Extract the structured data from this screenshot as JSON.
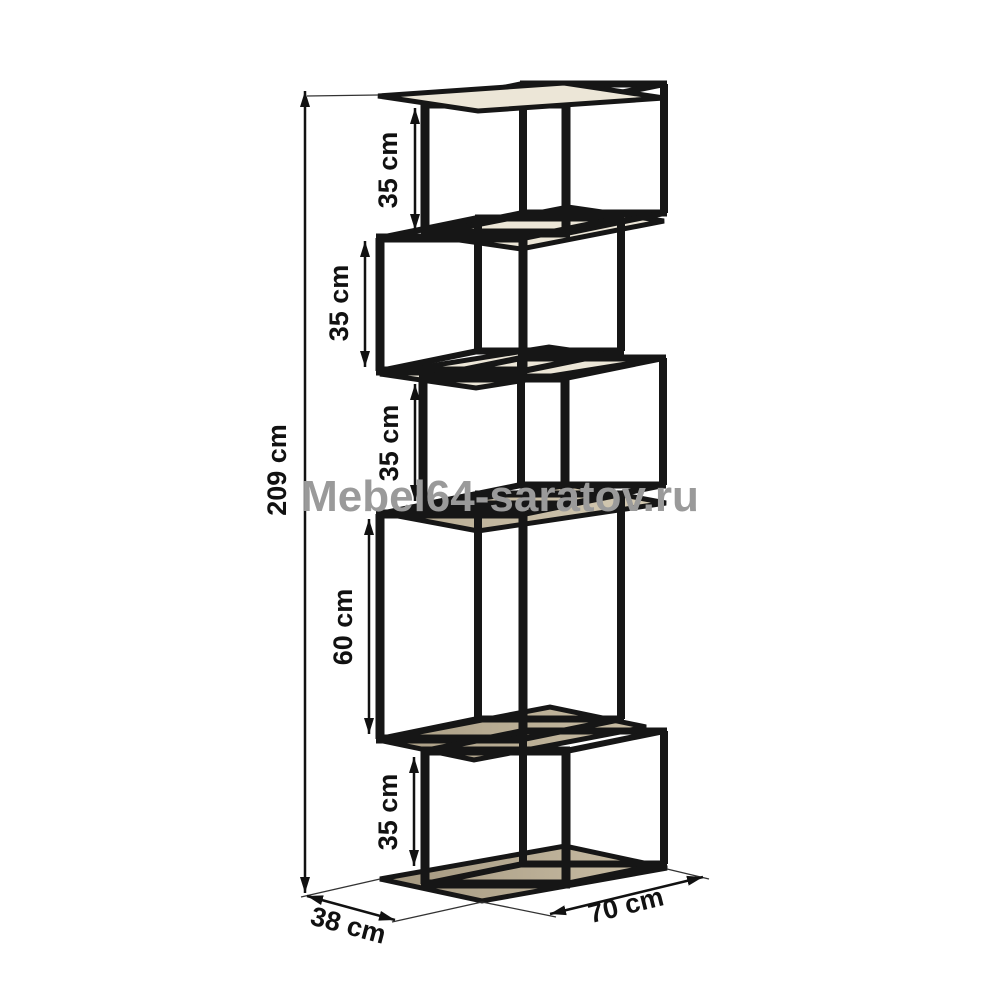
{
  "watermark": {
    "text": "Mebel64-saratov.ru",
    "color": "#9a9a9a"
  },
  "colors": {
    "frame": "#161616",
    "dimension_line": "#111111",
    "wood_dark": "#a2967e",
    "wood_mid": "#b6aa91",
    "wood_light": "#cdc1a8",
    "cream": "#ece6d7",
    "background": "#ffffff",
    "watermark_gray": "#9a9a9a"
  },
  "figure": {
    "description": "zigzag-shelving-unit-dimension-drawing",
    "total_height_label": "209 cm",
    "section_labels": [
      "35 cm",
      "35 cm",
      "35 cm",
      "60 cm",
      "35 cm"
    ],
    "depth_label": "38 cm",
    "width_label": "70 cm",
    "boxes": [
      {
        "fx1": 425,
        "fx2": 566,
        "fy1": 104,
        "fy2": 233,
        "dx": 98,
        "dy": -20
      },
      {
        "fx1": 380,
        "fx2": 523,
        "fy1": 238,
        "fy2": 371,
        "dx": 98,
        "dy": -20
      },
      {
        "fx1": 423,
        "fx2": 565,
        "fy1": 378,
        "fy2": 505,
        "dx": 98,
        "dy": -20
      },
      {
        "fx1": 380,
        "fx2": 523,
        "fy1": 514,
        "fy2": 739,
        "dx": 98,
        "dy": -20
      },
      {
        "fx1": 425,
        "fx2": 566,
        "fy1": 751,
        "fy2": 884,
        "dx": 98,
        "dy": -20
      }
    ],
    "shelves": [
      {
        "pts": "425,235 521,249 664,221 568,207",
        "fill": "#ece6d7",
        "layer": "back"
      },
      {
        "pts": "380,374 476,388 645,361 549,347",
        "fill": "#ece6d7",
        "layer": "back"
      },
      {
        "pts": "382,513 478,531 666,503 570,485",
        "fill": "gradMid",
        "layer": "back"
      },
      {
        "pts": "378,740 474,760 646,727 550,707",
        "fill": "gradWood",
        "layer": "back"
      },
      {
        "pts": "380,879 482,901 667,868 565,846",
        "fill": "gradFloor",
        "layer": "back"
      },
      {
        "pts": "378,96 478,111 664,98 564,83",
        "fill": "#ece6d7",
        "layer": "front"
      }
    ],
    "extensions": [
      {
        "x1": 307,
        "y1": 96,
        "x2": 378,
        "y2": 95
      },
      {
        "x1": 380,
        "y1": 879,
        "x2": 301,
        "y2": 897
      },
      {
        "x1": 482,
        "y1": 902,
        "x2": 392,
        "y2": 922
      },
      {
        "x1": 482,
        "y1": 902,
        "x2": 556,
        "y2": 917
      },
      {
        "x1": 667,
        "y1": 869,
        "x2": 709,
        "y2": 879
      }
    ],
    "dims": [
      {
        "name": "dim-total-height",
        "label": "209 cm",
        "x1": 305,
        "y1": 91,
        "x2": 305,
        "y2": 893,
        "lx": 286,
        "ly": 470,
        "rot": -90
      },
      {
        "name": "dim-section-1",
        "label": "35 cm",
        "x1": 415,
        "y1": 108,
        "x2": 415,
        "y2": 230,
        "lx": 397,
        "ly": 170,
        "rot": -90
      },
      {
        "name": "dim-section-2",
        "label": "35 cm",
        "x1": 365,
        "y1": 241,
        "x2": 365,
        "y2": 367,
        "lx": 348,
        "ly": 303,
        "rot": -90
      },
      {
        "name": "dim-section-3",
        "label": "35 cm",
        "x1": 415,
        "y1": 384,
        "x2": 415,
        "y2": 501,
        "lx": 398,
        "ly": 443,
        "rot": -90
      },
      {
        "name": "dim-section-4",
        "label": "60 cm",
        "x1": 369,
        "y1": 519,
        "x2": 369,
        "y2": 734,
        "lx": 352,
        "ly": 627,
        "rot": -90
      },
      {
        "name": "dim-section-5",
        "label": "35 cm",
        "x1": 414,
        "y1": 757,
        "x2": 414,
        "y2": 866,
        "lx": 397,
        "ly": 812,
        "rot": -90
      },
      {
        "name": "dim-depth",
        "label": "38 cm",
        "x1": 307,
        "y1": 896,
        "x2": 395,
        "y2": 920,
        "lx": 346,
        "ly": 934,
        "rot": 15
      },
      {
        "name": "dim-width",
        "label": "70 cm",
        "x1": 550,
        "y1": 914,
        "x2": 703,
        "y2": 877,
        "lx": 628,
        "ly": 914,
        "rot": -14
      }
    ]
  }
}
